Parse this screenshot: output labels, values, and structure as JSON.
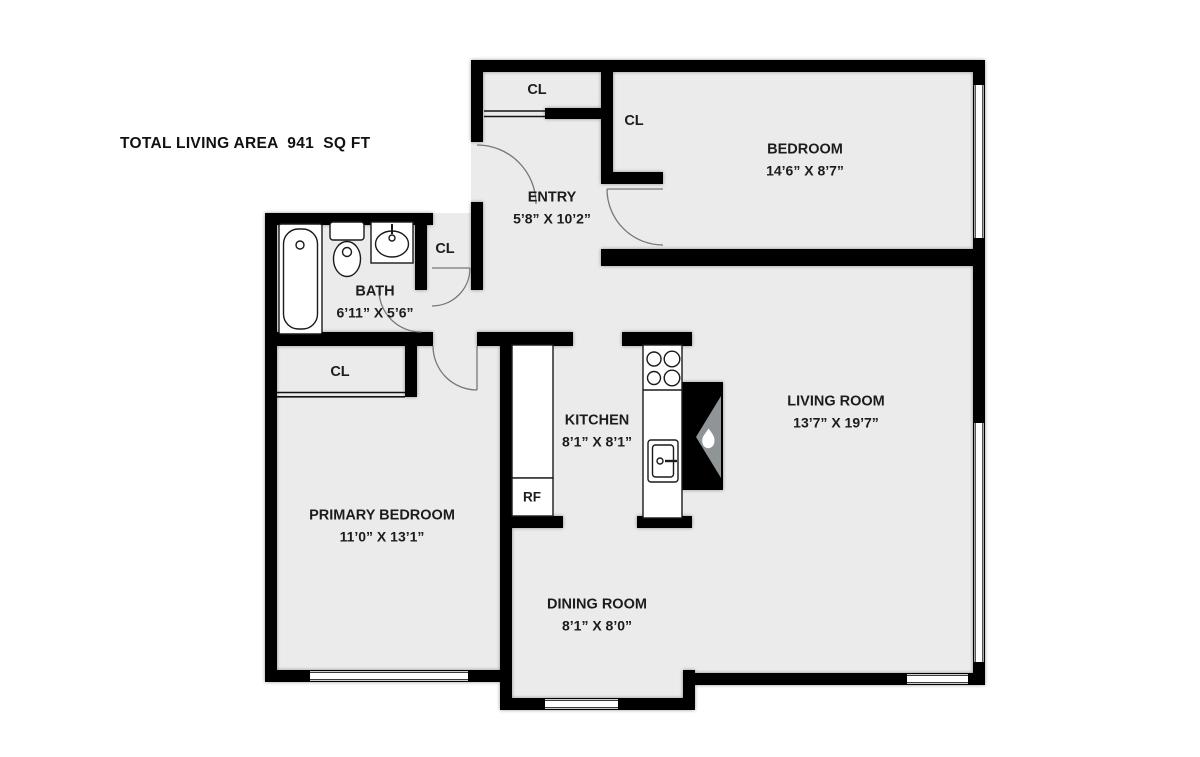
{
  "header": {
    "total_area_label": "TOTAL LIVING AREA  941  SQ FT"
  },
  "rooms": {
    "bedroom": {
      "name": "BEDROOM",
      "dims": "14’6” X 8’7”"
    },
    "entry": {
      "name": "ENTRY",
      "dims": "5’8” X 10’2”"
    },
    "bath": {
      "name": "BATH",
      "dims": "6’11” X 5’6”"
    },
    "kitchen": {
      "name": "KITCHEN",
      "dims": "8’1” X 8’1”"
    },
    "living_room": {
      "name": "LIVING ROOM",
      "dims": "13’7” X 19’7”"
    },
    "primary_bedroom": {
      "name": "PRIMARY BEDROOM",
      "dims": "11’0” X 13’1”"
    },
    "dining_room": {
      "name": "DINING ROOM",
      "dims": "8’1” X 8’0”"
    }
  },
  "closets": {
    "entry_closet": "CL",
    "bedroom_closet": "CL",
    "hall_closet": "CL",
    "primary_closet": "CL"
  },
  "appliances": {
    "refrigerator": "RF"
  },
  "colors": {
    "floor": "#ebebeb",
    "wall": "#000000",
    "door_line": "#777777",
    "fireplace_insert": "#8f9496"
  }
}
